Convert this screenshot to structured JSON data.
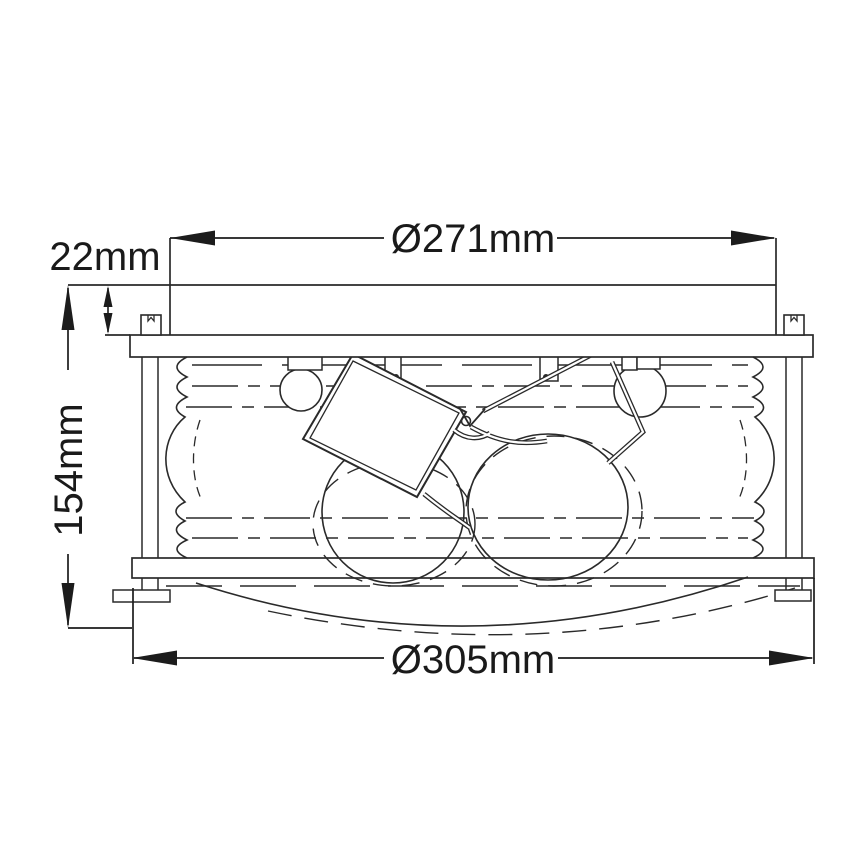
{
  "drawing": {
    "units": "mm",
    "colors": {
      "background": "#ffffff",
      "line": "#2a2a2a",
      "text": "#1a1a1a"
    },
    "dimensions": {
      "top_diameter": {
        "label": "Ø271mm",
        "value_mm": 271
      },
      "canopy_height": {
        "label": "22mm",
        "value_mm": 22
      },
      "overall_height": {
        "label": "154mm",
        "value_mm": 154
      },
      "bottom_diameter": {
        "label": "Ø305mm",
        "value_mm": 305
      }
    }
  }
}
